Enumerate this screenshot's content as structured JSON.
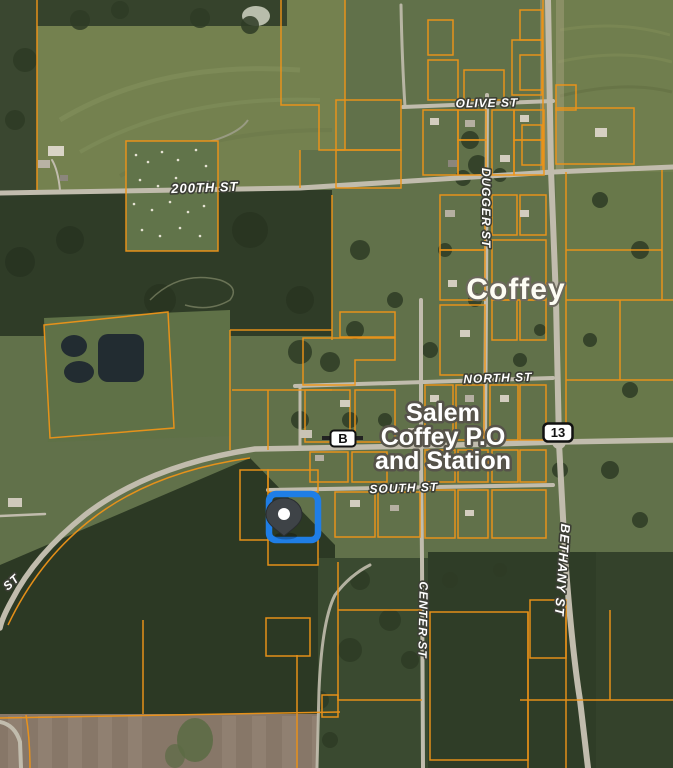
{
  "map": {
    "kind": "satellite-parcel-map",
    "place": {
      "town": "Coffey",
      "poi_lines": [
        "Salem",
        "Coffey P.O",
        "and Station"
      ]
    },
    "street_labels": [
      {
        "id": "olive",
        "text": "OLIVE ST"
      },
      {
        "id": "two-hundredth",
        "text": "200TH ST"
      },
      {
        "id": "dugger",
        "text": "DUGGER ST"
      },
      {
        "id": "north",
        "text": "NORTH ST"
      },
      {
        "id": "south",
        "text": "SOUTH ST"
      },
      {
        "id": "bethany",
        "text": "BETHANY ST"
      },
      {
        "id": "center",
        "text": "CENTER ST"
      },
      {
        "id": "left-partial",
        "text": "ST"
      }
    ],
    "route_shields": [
      {
        "id": "route-b",
        "text": "B"
      },
      {
        "id": "route-13",
        "text": "13"
      }
    ],
    "marker": {
      "type": "selected-parcel",
      "description": "blue rounded-square parcel highlight with dark location pin"
    },
    "colors": {
      "parcel_line": "#ee9418",
      "road": "#c1bcad",
      "selection_blue": "#1f7ee6",
      "pin_body": "#3e4347",
      "label_fill": "#ffffff",
      "label_halo": "#3c3e35",
      "forest": "#2e3b26",
      "field": "#61714a",
      "tilled_field": "#877768",
      "water": "#222c31"
    }
  }
}
